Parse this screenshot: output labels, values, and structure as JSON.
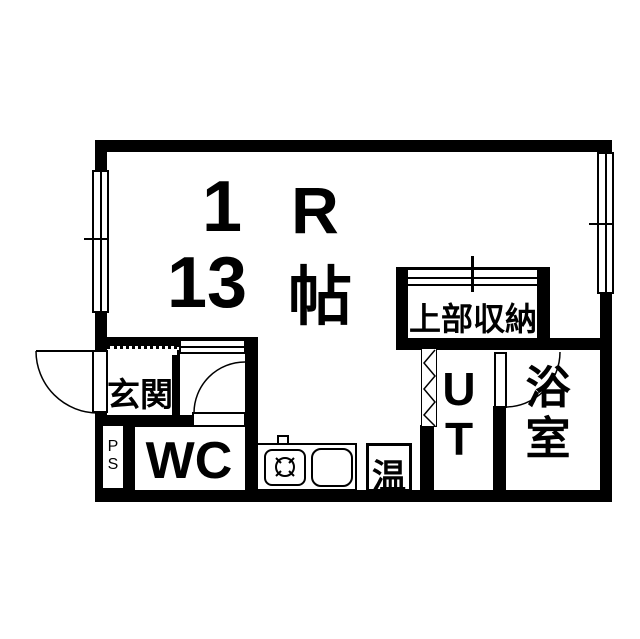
{
  "floor_plan": {
    "main_room": {
      "count": "1",
      "type": "R",
      "size": "13",
      "unit": "帖"
    },
    "rooms": {
      "entrance_label": "玄関",
      "wc_label": "WC",
      "pipe_space_label": "P\nS",
      "water_heater_label": "温",
      "utility_label": "U\nT",
      "bathroom_label": "浴\n室",
      "upper_storage_label": "上部収納"
    },
    "colors": {
      "wall": "#000000",
      "background": "#ffffff"
    }
  }
}
